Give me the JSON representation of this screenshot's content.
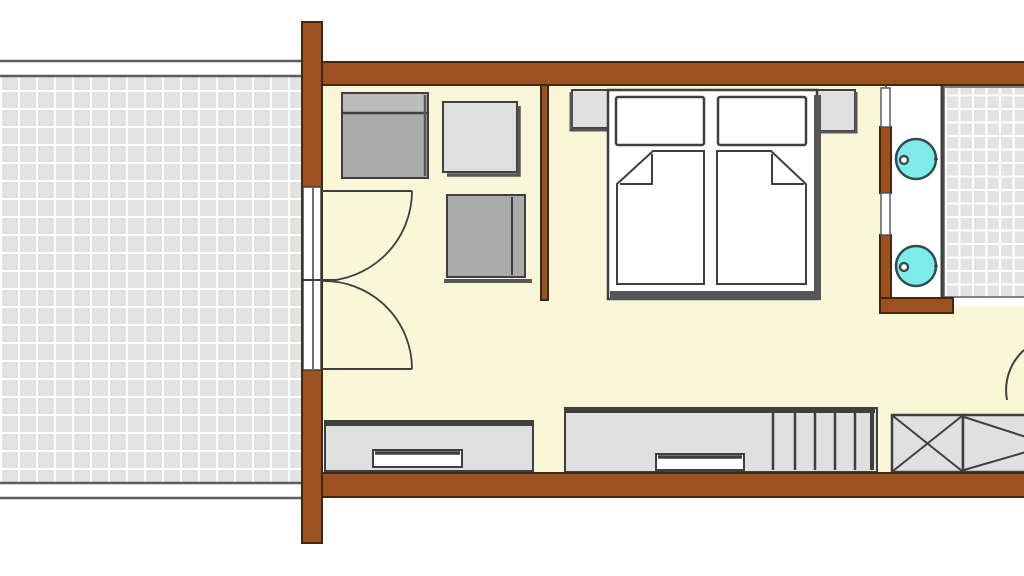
{
  "meta": {
    "type": "architectural floor plan",
    "description": "Hotel room floor plan: tiled terrace at left, entry with double french doors, wardrobe and seating, double bed with two mattresses and nightstands, vanity counter with two round washbasins, tiled bathroom at top right with swing door, sideboards with drawers, staircase treads, crossed shaft box and luggage rack along bottom wall."
  },
  "rooms": {
    "terrace": "terrace",
    "entry": "entry area",
    "bedroom": "bedroom",
    "bathroom": "bathroom"
  },
  "elements": {
    "walls": [
      "top-wall",
      "bottom-wall",
      "left-pillar",
      "entry-partition",
      "bathroom-divider",
      "bathroom-stub-wall"
    ],
    "doors": [
      "entry-double-door",
      "bathroom-swing-door"
    ],
    "furniture": [
      "wardrobe-dresser",
      "side-table",
      "armchair",
      "nightstand-left",
      "nightstand-right",
      "double-bed",
      "pillow-left",
      "pillow-right",
      "mattress-left",
      "mattress-right",
      "sideboard-left",
      "sideboard-with-stairs",
      "stair-treads",
      "shaft-box-x",
      "luggage-rack"
    ],
    "fixtures": [
      "vanity-counter",
      "washbasin-top",
      "washbasin-bottom"
    ]
  },
  "colors": {
    "bg": "#ffffff",
    "wall": "#9d5020",
    "wallEdge": "#3c2a18",
    "floor": "#faf7d9",
    "tile": "#e3e3e3",
    "tileLine": "#ffffff",
    "outline": "#3f3f3f",
    "softOutline": "#5d5d5d",
    "white": "#ffffff",
    "grayDark": "#ababab",
    "grayDarkTop": "#bcbcbc",
    "grayLight": "#e0e0e0",
    "shadow": "#565656",
    "sink": "#7debe9",
    "sinkEdge": "#2f4f4f"
  }
}
